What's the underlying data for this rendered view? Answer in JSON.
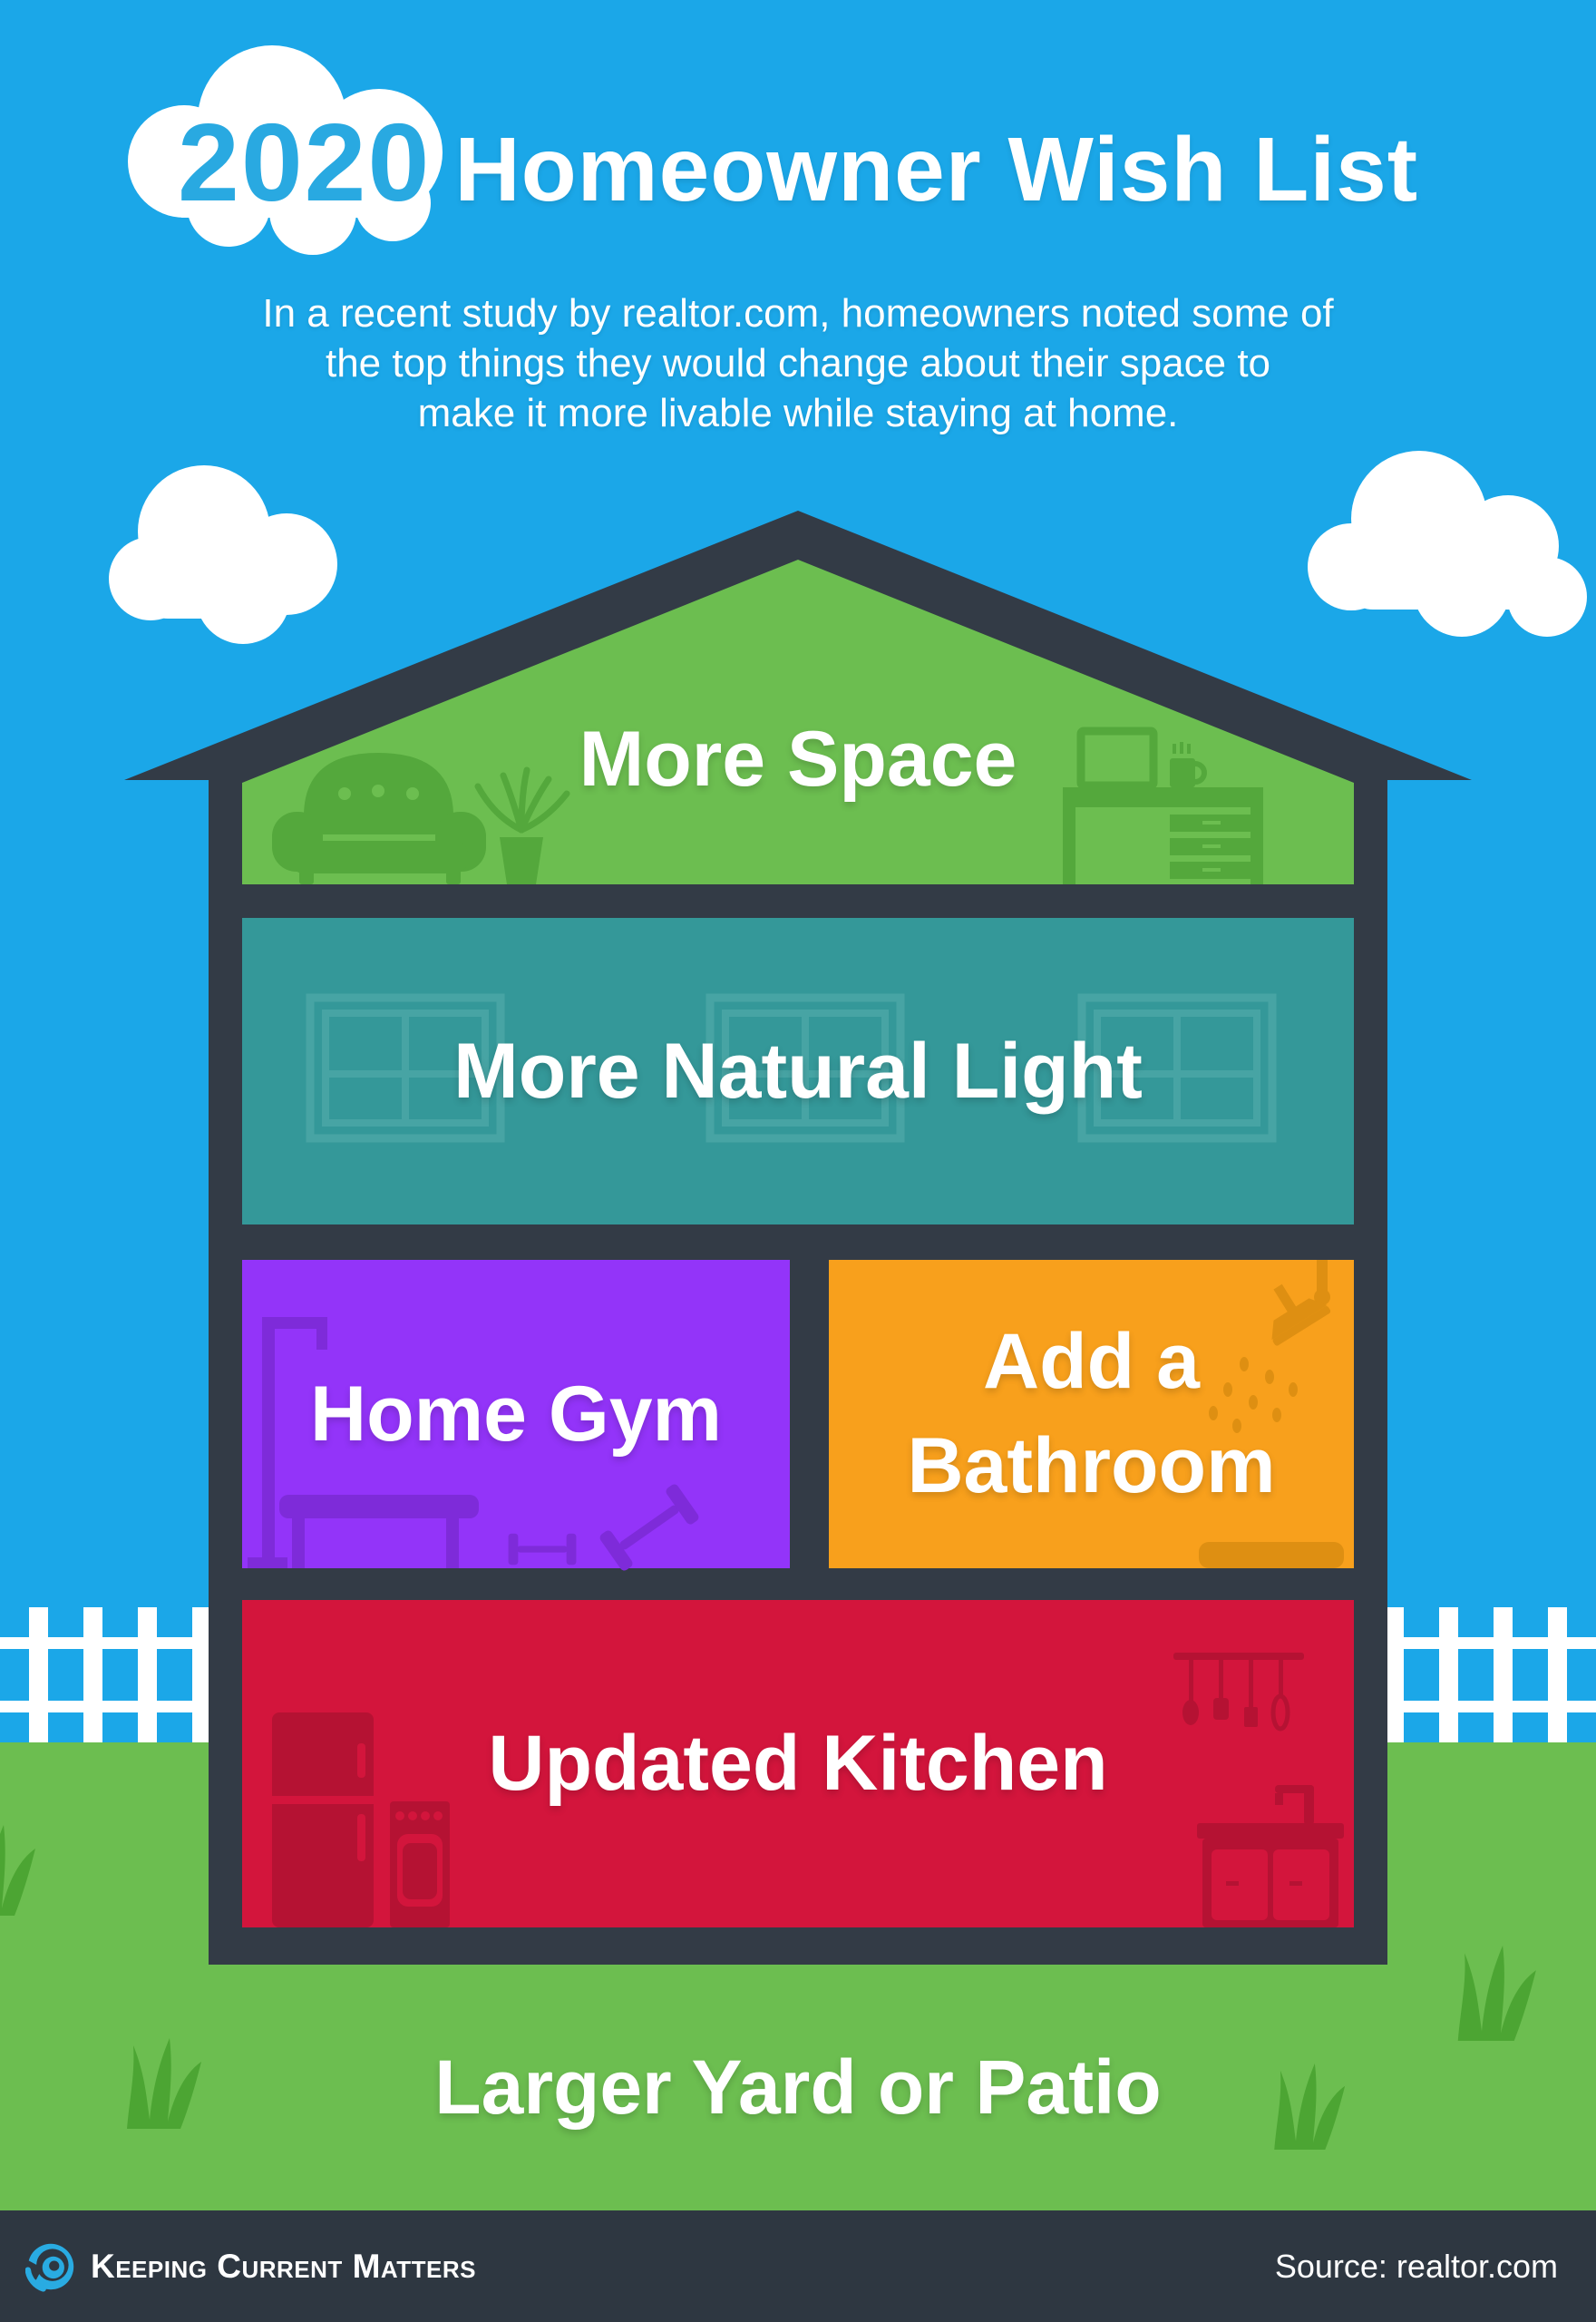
{
  "title": {
    "year": "2020",
    "main": "Homeowner Wish List"
  },
  "subtitle": {
    "lines": [
      "In a recent study by realtor.com, homeowners noted some of",
      "the top things they would change about their space to",
      "make it more livable while staying at home."
    ]
  },
  "house": {
    "attic": {
      "label": "More Space"
    },
    "floor2": {
      "label": "More Natural Light"
    },
    "gym": {
      "label": "Home Gym"
    },
    "bathroom": {
      "label": "Add a Bathroom"
    },
    "kitchen": {
      "label": "Updated Kitchen"
    }
  },
  "yard": {
    "label": "Larger Yard or Patio"
  },
  "footer": {
    "brand": "Keeping Current Matters",
    "source": "Source: realtor.com"
  },
  "colors": {
    "sky": "#1BA7E8",
    "cloud": "#FFFFFF",
    "roof_frame": "#333B46",
    "attic_green": "#6CBE50",
    "attic_furniture": "#54A83C",
    "teal": "#349899",
    "teal_window": "#47A4A4",
    "purple": "#9334F9",
    "purple_equipment": "#7E2BD9",
    "orange": "#F8A01C",
    "orange_fixture": "#DE8F12",
    "red": "#D3153C",
    "red_appliance": "#B51233",
    "grass": "#6CBE50",
    "grass_tuft": "#4CA533",
    "fence": "#FFFFFF",
    "footer_bg": "#2E3741",
    "brand_blue": "#29ABE2",
    "year_blue": "#29A9E1",
    "label_text": "#FFFFFF"
  },
  "icons": {
    "cloud": "cloud-icon",
    "sofa": "sofa-icon",
    "plant": "houseplant-icon",
    "desk": "desk-icon",
    "monitor": "monitor-icon",
    "mug": "mug-icon",
    "window": "window-icon",
    "gym_rack": "gym-rack-icon",
    "gym_bench": "gym-bench-icon",
    "dumbbell": "dumbbell-icon",
    "shower": "shower-head-icon",
    "bath_mat": "bath-mat-icon",
    "fridge": "refrigerator-icon",
    "stove": "stove-icon",
    "utensils": "kitchen-utensils-icon",
    "sink": "sink-cabinet-icon",
    "fence": "picket-fence",
    "grass_tuft": "grass-tuft-icon",
    "logo": "kcm-swirl-logo-icon"
  }
}
